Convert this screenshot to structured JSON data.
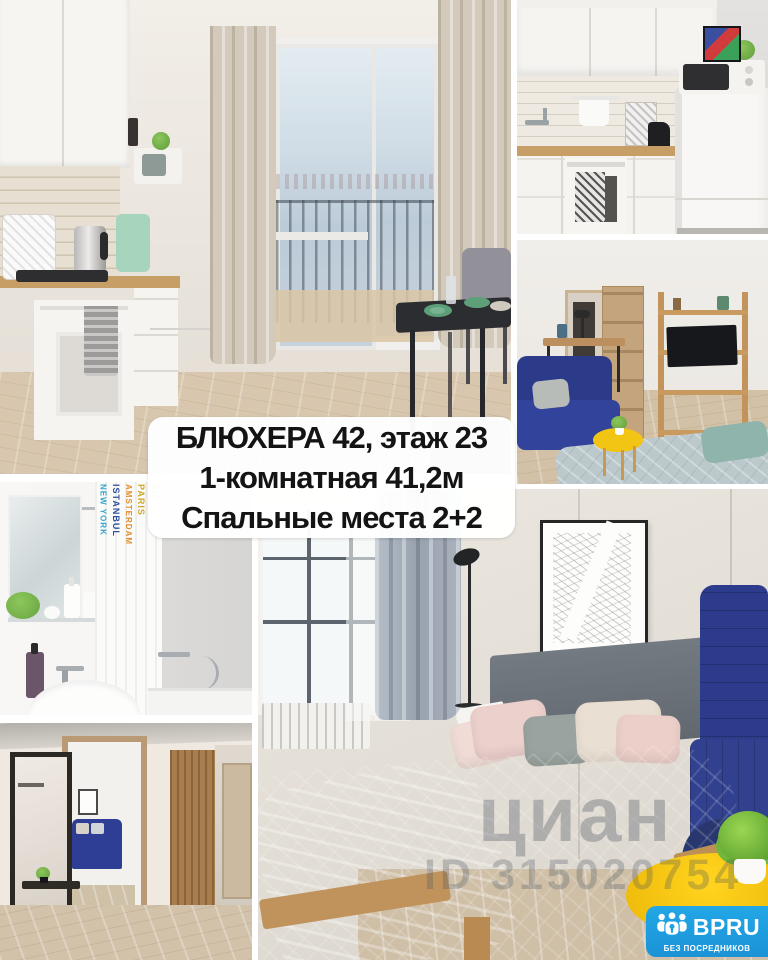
{
  "overlay": {
    "line1": "БЛЮХЕРА 42, этаж 23",
    "line2": "1-комнатная 41,2м",
    "line3": "Спальные места 2+2"
  },
  "watermark": {
    "brand": "циан",
    "listing_id": "ID 315020754"
  },
  "badge": {
    "brand": "BPRU",
    "tagline": "БЕЗ ПОСРЕДНИКОВ",
    "bg_color": "#1da1e2"
  },
  "bathroom_curtain_words": [
    "NEW YORK",
    "ISTANBUL",
    "AMSTERDAM",
    "PARIS",
    "RIO"
  ],
  "photos": [
    {
      "id": "kitchen-main",
      "desc": "White kitchen with balcony door, beige curtains and black dining table"
    },
    {
      "id": "kitchen-detail",
      "desc": "Kitchen counter with oven, black kettle, fridge and microwave"
    },
    {
      "id": "living-room",
      "desc": "Room with blue sofa, desk, open door, wooden shelf with TV and yellow table"
    },
    {
      "id": "bathroom",
      "desc": "Bathroom with mirror, printed shower curtain, sink and bathtub"
    },
    {
      "id": "hallway",
      "desc": "Hallway with black framed mirror, doorway to room and wooden wardrobe"
    },
    {
      "id": "bedroom",
      "desc": "Bedroom with gray quilted bed, city map poster, blue sofa and yellow coffee table"
    }
  ],
  "colors": {
    "accent_yellow": "#f2c414",
    "sofa_blue": "#2d3b8c",
    "badge_blue": "#1da1e2",
    "wood_floor": "#d2c2aa",
    "gutter": "#ffffff"
  }
}
